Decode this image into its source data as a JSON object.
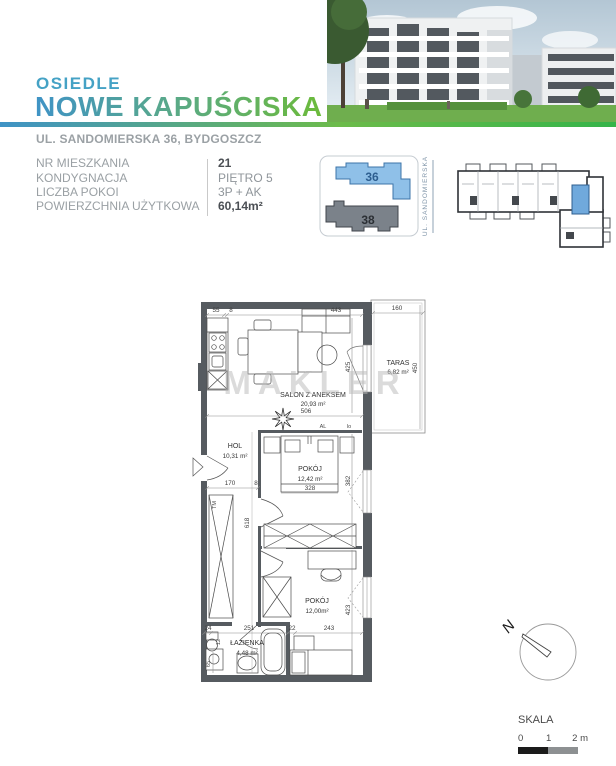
{
  "brand": {
    "label": "OSIEDLE",
    "name": "NOWE KAPUŚCISKA",
    "address": "UL. SANDOMIERSKA 36, BYDGOSZCZ"
  },
  "colors": {
    "teal": "#45a2c5",
    "gradient_start": "#3f93c6",
    "gradient_end": "#35b44a",
    "highlight_blue": "#8fc0e8",
    "wall_gray": "#565b60"
  },
  "info": {
    "rows": [
      {
        "label": "NR MIESZKANIA",
        "value": "21"
      },
      {
        "label": "KONDYGNACJA",
        "value": "PIĘTRO 5"
      },
      {
        "label": "LICZBA POKOI",
        "value": "3P + AK"
      },
      {
        "label": "POWIERZCHNIA UŻYTKOWA",
        "value": "60,14m²"
      }
    ]
  },
  "site_plan": {
    "building_36": "36",
    "building_38": "38",
    "street_label": "UL. SANDOMIERSKA"
  },
  "floor_plan": {
    "watermark": "MAKLER",
    "rooms": {
      "salon": {
        "name": "SALON Z ANEKSEM",
        "area": "20,93 m²"
      },
      "taras": {
        "name": "TARAS",
        "area": "6,82 m²"
      },
      "hol": {
        "name": "HOL",
        "area": "10,31 m²"
      },
      "pokoj1": {
        "name": "POKÓJ",
        "area": "12,42 m²"
      },
      "pokoj2": {
        "name": "POKÓJ",
        "area": "12,00m²"
      },
      "lazienka": {
        "name": "ŁAZIENKA",
        "area": "4,48 m²"
      }
    },
    "dims": {
      "d55": "55",
      "d8a": "8",
      "d443": "443",
      "d160": "160",
      "d425": "425",
      "d450": "450",
      "d506": "506",
      "dal": "AL",
      "dlo": "lo",
      "d170": "170",
      "d8b": "8",
      "d618": "618",
      "d328": "328",
      "d382": "382",
      "d423": "423",
      "d24": "24",
      "d251": "251",
      "d22": "22",
      "d243": "243",
      "d65": "65",
      "d12": "12",
      "dtm": "TM"
    }
  },
  "compass": {
    "north": "N"
  },
  "scale": {
    "label": "SKALA",
    "tick0": "0",
    "tick1": "1",
    "tick2": "2 m"
  }
}
